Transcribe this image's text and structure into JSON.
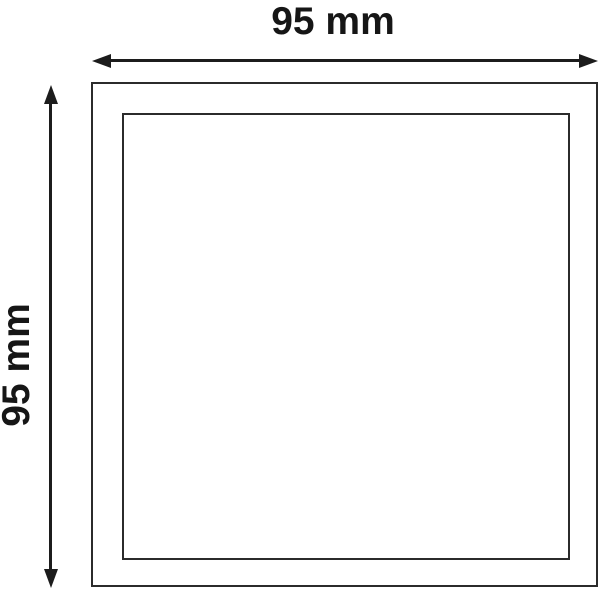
{
  "diagram": {
    "title": "square panel dimension drawing",
    "width_dimension": {
      "label": "95 mm",
      "value_mm": 95,
      "orientation": "horizontal"
    },
    "height_dimension": {
      "label": "95 mm",
      "value_mm": 95,
      "orientation": "vertical"
    },
    "colors": {
      "background": "#ffffff",
      "line": "#2b2b2b",
      "arrow": "#1c1c1c",
      "text": "#161616"
    },
    "icons": {
      "arrowhead_left": "left-pointing solid triangle",
      "arrowhead_right": "right-pointing solid triangle",
      "arrowhead_up": "up-pointing solid triangle",
      "arrowhead_down": "down-pointing solid triangle"
    }
  }
}
